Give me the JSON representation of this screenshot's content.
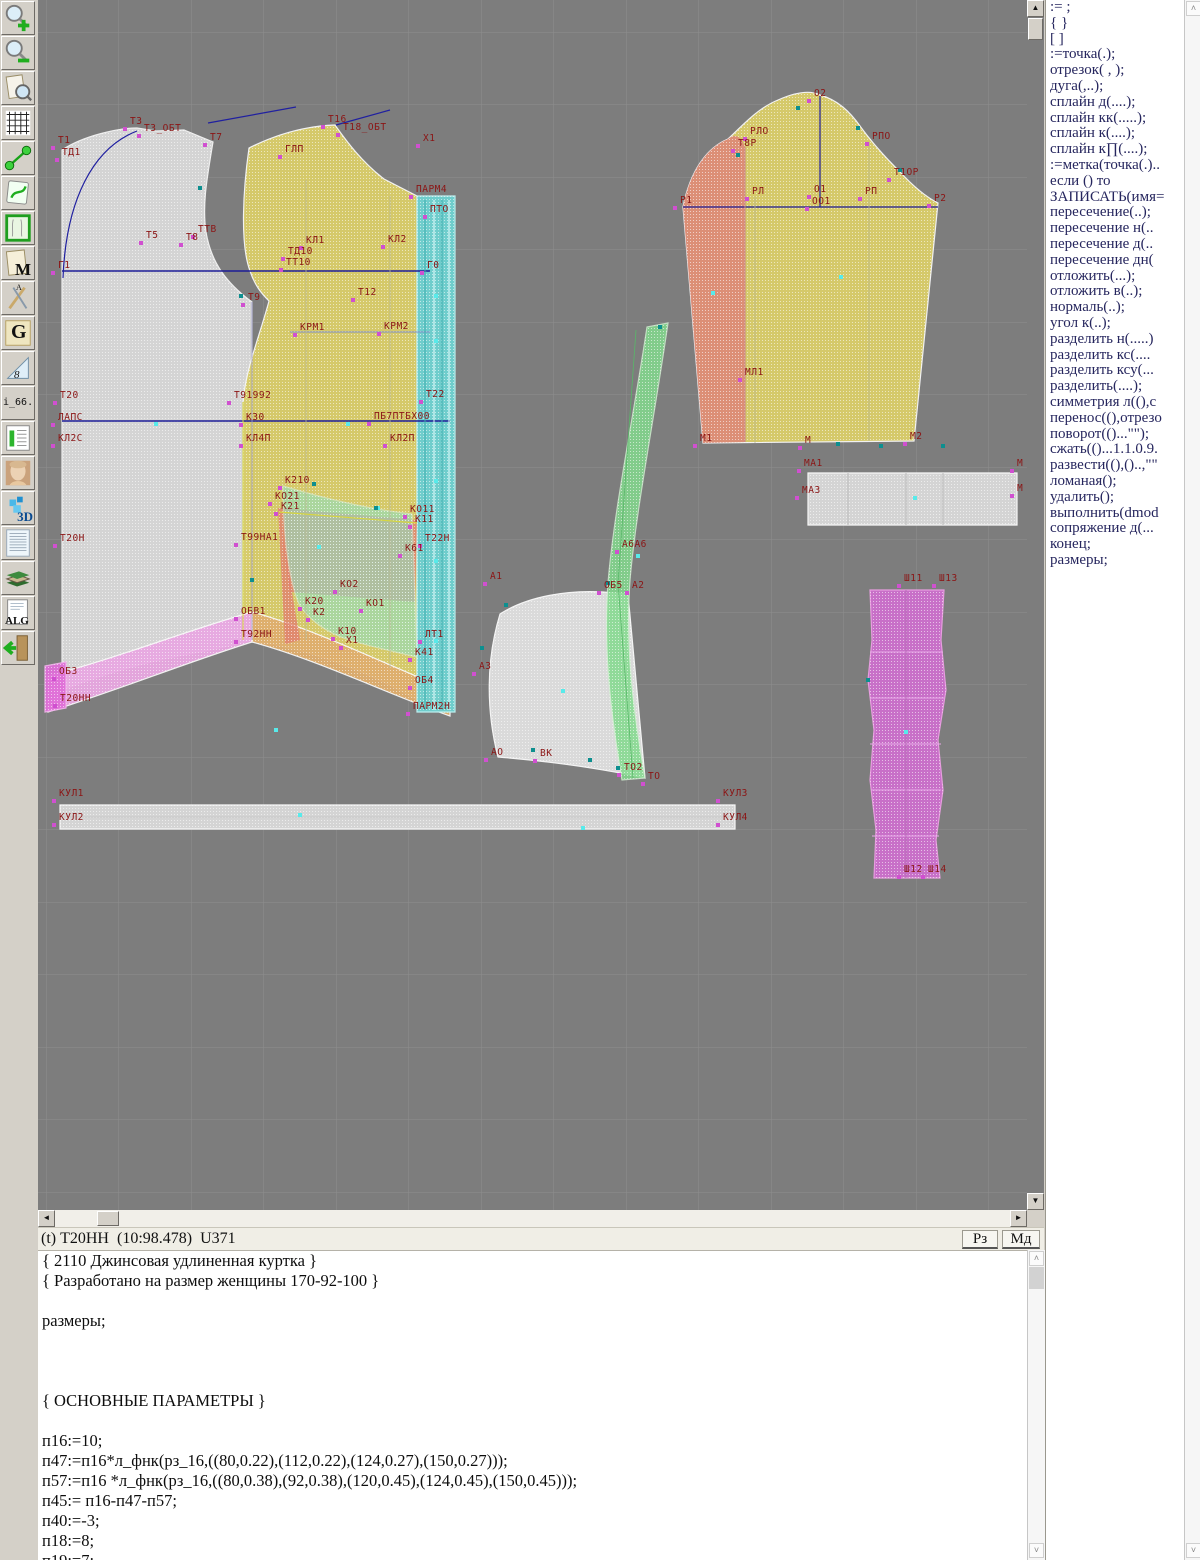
{
  "toolbar": {
    "items": [
      {
        "name": "zoom-in-tool"
      },
      {
        "name": "zoom-out-tool"
      },
      {
        "name": "preview-tool"
      },
      {
        "name": "grid-tool"
      },
      {
        "name": "measure-tool"
      },
      {
        "name": "sketch-tool"
      },
      {
        "name": "pattern-frame-tool"
      },
      {
        "name": "m-document-tool",
        "glyph": "M"
      },
      {
        "name": "drafting-tool",
        "glyph": "A"
      },
      {
        "name": "g-curves-tool",
        "glyph": "G"
      },
      {
        "name": "ruler-tool",
        "glyph": "8"
      },
      {
        "name": "i66-tool",
        "glyph": "i_66."
      },
      {
        "name": "size-table-tool"
      },
      {
        "name": "portrait-tool"
      },
      {
        "name": "three-d-tool",
        "glyph": "3D"
      },
      {
        "name": "text-page-tool"
      },
      {
        "name": "books-tool"
      },
      {
        "name": "alg-tool",
        "glyph": "ALG"
      },
      {
        "name": "exit-tool"
      }
    ]
  },
  "drawing": {
    "bg": "#7d7d7d",
    "grid_color": "#8e8e8e",
    "label_color": "#8b1515",
    "accent_navy": "#1c1c96",
    "marker_magenta": "#d050d0",
    "marker_cyan": "#58eaea",
    "marker_teal": "#0d8f8f",
    "pieces": [
      {
        "n": "back-piece",
        "p": "M 24,690 C 60,676 100,664 140,656 C 168,651 192,646 214,640 L 214,302 C 188,283 173,262 168,232 C 164,205 169,178 175,142 L 146,130 L 118,131 L 99,128 C 80,128 45,136 24,150 Z",
        "f": "#d9d9d9",
        "s": "#f5f5f5",
        "o": 0.95
      },
      {
        "n": "front-piece",
        "p": "M 211,148 C 237,135 267,126 297,125 C 309,142 324,162 346,179 L 379,196 L 379,700 C 332,672 266,646 205,640 L 205,402 C 208,368 221,338 231,301 C 224,294 217,286 212,271 C 202,244 205,190 211,148 Z",
        "f": "#d8cc6a",
        "s": "#f5f5f5",
        "o": 0.97
      },
      {
        "n": "hem-band-pink",
        "p": "M 10,676 C 80,658 150,630 214,612 L 214,642 C 150,662 80,690 10,712 Z",
        "f": "#e9a8e2",
        "s": "#f8f8f8",
        "o": 0.95
      },
      {
        "n": "hem-block-pink",
        "p": "M 7,666 L 28,662 L 28,708 L 7,712 Z",
        "f": "#e070d8",
        "s": "#f0b0ea",
        "o": 0.95
      },
      {
        "n": "hem-band-salmon",
        "p": "M 214,612 C 280,630 350,666 412,690 L 412,716 C 350,694 280,660 214,642 Z",
        "f": "#dfae6e",
        "s": "#f8f8f8",
        "o": 0.95
      },
      {
        "n": "facing-strip-cyan",
        "p": "M 379,196 L 417,196 L 417,712 L 379,712 Z",
        "f": "#6fd0cf",
        "s": "#bff2f2",
        "o": 0.97
      },
      {
        "n": "pocket-red",
        "p": "M 240,508 L 379,520 L 377,602 L 252,592 Z",
        "f": "#e08070",
        "s": "none",
        "o": 0.78
      },
      {
        "n": "pocket-red-sliver",
        "p": "M 240,508 L 262,640 L 247,644 Z",
        "f": "#e08070",
        "s": "none",
        "o": 0.78
      },
      {
        "n": "pocket-teal",
        "p": "M 245,486 C 292,500 336,510 374,514 L 379,657 C 348,650 318,643 303,637 C 283,629 268,616 261,604 C 250,578 245,528 245,486 Z",
        "f": "#90dfc2",
        "s": "#cfeedd",
        "o": 0.6
      },
      {
        "n": "sleeve-piece",
        "p": "M 645,207 C 652,172 668,148 690,139 C 705,125 720,108 740,100 C 758,92 772,90 782,95 C 800,100 812,112 822,126 C 832,140 845,155 862,172 C 875,186 888,197 900,203 L 876,441 L 665,443 Z",
        "f": "#d8cc6a",
        "s": "#f5f5f5",
        "o": 0.97
      },
      {
        "n": "sleeve-undersection",
        "p": "M 645,207 C 652,172 668,148 690,139 C 698,132 704,138 707,147 L 707,442 L 665,443 Z",
        "f": "#dd8878",
        "s": "none",
        "o": 0.9
      },
      {
        "n": "cuff-strip",
        "p": "M 770,473 L 979,473 L 979,525 L 770,525 Z",
        "f": "#d9d9d9",
        "s": "#ffffff",
        "o": 0.95
      },
      {
        "n": "collar-piece",
        "p": "M 462,614 C 490,596 530,590 565,592 L 590,594 L 598,680 L 607,778 C 570,770 520,762 460,757 C 448,710 448,660 462,614 Z",
        "f": "#e0e0e0",
        "s": "#fbfbfb",
        "o": 0.95
      },
      {
        "n": "binding-strip-green",
        "p": "M 609,327 L 630,323 C 616,420 598,510 592,580 C 587,650 596,715 607,778 L 584,780 C 573,715 565,650 570,583 C 576,510 595,420 609,327 Z",
        "f": "#84da8e",
        "s": "#cfeecf",
        "o": 0.85
      },
      {
        "n": "placket-magenta",
        "p": "M 832,590 L 906,590 L 903,640 L 908,690 L 900,740 L 905,790 L 898,840 L 902,878 L 836,878 L 838,830 L 832,780 L 836,730 L 830,680 L 834,640 Z",
        "f": "#cf6fcf",
        "s": "#f0a0e8",
        "o": 0.92
      },
      {
        "n": "belt-strip",
        "p": "M 22,805 L 697,805 L 697,829 L 22,829 Z",
        "f": "#d9d9d9",
        "s": "#ffffff",
        "o": 0.95
      }
    ],
    "lines": [
      {
        "p": "M 24,271 L 392,271",
        "c": "#1c1c96",
        "w": 1.5
      },
      {
        "p": "M 24,421 L 412,421",
        "c": "#1c1c96",
        "w": 1.5
      },
      {
        "p": "M 25,278 C 28,200 55,148 99,131",
        "c": "#2020a0",
        "w": 1.2
      },
      {
        "p": "M 170,123 L 258,107",
        "c": "#2020a0",
        "w": 1.2
      },
      {
        "p": "M 298,125 L 352,110",
        "c": "#2020a0",
        "w": 1.2
      },
      {
        "p": "M 645,207 L 900,207",
        "c": "#1c1c96",
        "w": 1.2
      },
      {
        "p": "M 782,96 L 782,207",
        "c": "#1c1c96",
        "w": 1.2
      },
      {
        "p": "M 252,332 L 392,332",
        "c": "#8090c8",
        "w": 1
      },
      {
        "p": "M 268,180 L 268,640",
        "c": "#b8b890",
        "w": 0.8
      },
      {
        "p": "M 352,196 L 352,668",
        "c": "#b8b890",
        "w": 0.8
      },
      {
        "p": "M 241,512 L 379,523",
        "c": "#d6d640",
        "w": 1.2
      },
      {
        "p": "M 205,402 L 205,640",
        "c": "#d6d640",
        "w": 1
      },
      {
        "p": "M 214,302 L 214,640",
        "c": "#9898c8",
        "w": 0.8
      },
      {
        "p": "M 387,200 L 387,710",
        "c": "#3fafaf",
        "w": 1
      },
      {
        "p": "M 396,200 L 396,710",
        "c": "#e8ffff",
        "w": 1
      },
      {
        "p": "M 404,200 L 404,710",
        "c": "#3fafaf",
        "w": 1
      },
      {
        "p": "M 411,200 L 411,710",
        "c": "#e8ffff",
        "w": 1
      },
      {
        "p": "M 707,147 L 707,442",
        "c": "#cc8888",
        "w": 1
      },
      {
        "p": "M 717,197 L 717,443",
        "c": "#b8b890",
        "w": 0.8
      },
      {
        "p": "M 831,142 L 831,441",
        "c": "#b8b890",
        "w": 0.8
      },
      {
        "p": "M 810,473 L 810,525",
        "c": "#bbbbbb",
        "w": 1
      },
      {
        "p": "M 868,473 L 868,525",
        "c": "#bbbbbb",
        "w": 1
      },
      {
        "p": "M 905,473 L 905,525",
        "c": "#bbbbbb",
        "w": 1
      },
      {
        "p": "M 22,817 L 697,817",
        "c": "#c8c8c8",
        "w": 1
      },
      {
        "p": "M 832,652 L 905,652",
        "c": "#e9a8e9",
        "w": 1
      },
      {
        "p": "M 832,698 L 906,698",
        "c": "#e9a8e9",
        "w": 1
      },
      {
        "p": "M 832,744 L 903,744",
        "c": "#e9a8e9",
        "w": 1
      },
      {
        "p": "M 833,790 L 903,790",
        "c": "#e9a8e9",
        "w": 1
      },
      {
        "p": "M 834,836 L 901,836",
        "c": "#e9a8e9",
        "w": 1
      },
      {
        "p": "M 868,590 L 868,878",
        "c": "#b86ab8",
        "w": 1
      },
      {
        "p": "M 598,330 L 580,583 L 595,778",
        "c": "#58b868",
        "w": 0.8
      }
    ],
    "labels": [
      [
        "Т1",
        20,
        143
      ],
      [
        "ТД1",
        24,
        155
      ],
      [
        "Т3",
        92,
        124
      ],
      [
        "Т3_ОБТ",
        106,
        131
      ],
      [
        "Т7",
        172,
        140
      ],
      [
        "Т5",
        108,
        238
      ],
      [
        "Т8",
        148,
        240
      ],
      [
        "ТТВ",
        160,
        232
      ],
      [
        "Г1",
        20,
        268
      ],
      [
        "Т9",
        210,
        300
      ],
      [
        "Т20",
        22,
        398
      ],
      [
        "ЛАПС",
        20,
        420
      ],
      [
        "КЛ2С",
        20,
        441
      ],
      [
        "Т20Н",
        22,
        541
      ],
      [
        "ОБ3",
        21,
        674
      ],
      [
        "Т20НН",
        22,
        701
      ],
      [
        "ГЛП",
        247,
        152
      ],
      [
        "Т16",
        290,
        122
      ],
      [
        "Т18_ОБТ",
        305,
        130
      ],
      [
        "Х1",
        385,
        141
      ],
      [
        "ПАРМ4",
        378,
        192
      ],
      [
        "ПТО",
        392,
        212
      ],
      [
        "КЛ1",
        268,
        243
      ],
      [
        "КЛ2",
        350,
        242
      ],
      [
        "ТД10",
        250,
        254
      ],
      [
        "ТТ10",
        248,
        265
      ],
      [
        "Г0",
        389,
        268
      ],
      [
        "Т12",
        320,
        295
      ],
      [
        "КРМ1",
        262,
        330
      ],
      [
        "КРМ2",
        346,
        329
      ],
      [
        "Т91992",
        196,
        398
      ],
      [
        "Т22",
        388,
        397
      ],
      [
        "К30",
        208,
        420
      ],
      [
        "ПБ7ПТБХ00",
        336,
        419
      ],
      [
        "КЛ4П",
        208,
        441
      ],
      [
        "КЛ2П",
        352,
        441
      ],
      [
        "К210",
        247,
        483
      ],
      [
        "КО21",
        237,
        499
      ],
      [
        "К21",
        243,
        509
      ],
      [
        "КО11",
        372,
        512
      ],
      [
        "К11",
        377,
        522
      ],
      [
        "Т99НА1",
        203,
        540
      ],
      [
        "Т22Н",
        387,
        541
      ],
      [
        "К61",
        367,
        551
      ],
      [
        "КО2",
        302,
        587
      ],
      [
        "К20",
        267,
        604
      ],
      [
        "КО1",
        328,
        606
      ],
      [
        "К2",
        275,
        615
      ],
      [
        "ОБВ1",
        203,
        614
      ],
      [
        "Т92НН",
        203,
        637
      ],
      [
        "К10",
        300,
        634
      ],
      [
        "Х1",
        308,
        643
      ],
      [
        "ЛТ1",
        387,
        637
      ],
      [
        "К41",
        377,
        655
      ],
      [
        "ОБ4",
        377,
        683
      ],
      [
        "ПАРМ2Н",
        375,
        709
      ],
      [
        "А1",
        452,
        579
      ],
      [
        "А3",
        441,
        669
      ],
      [
        "АО",
        453,
        755
      ],
      [
        "ВК",
        502,
        756
      ],
      [
        "ТО2",
        586,
        770
      ],
      [
        "ТО",
        610,
        779
      ],
      [
        "ОБ5",
        566,
        588
      ],
      [
        "А2",
        594,
        588
      ],
      [
        "А6А6",
        584,
        547
      ],
      [
        "О2",
        776,
        96
      ],
      [
        "РЛО",
        712,
        134
      ],
      [
        "Т8Р",
        700,
        146
      ],
      [
        "РПО",
        834,
        139
      ],
      [
        "Т1ОР",
        856,
        175
      ],
      [
        "РЛ",
        714,
        194
      ],
      [
        "О1",
        776,
        192
      ],
      [
        "ОО1",
        774,
        204
      ],
      [
        "РП",
        827,
        194
      ],
      [
        "Р1",
        642,
        203
      ],
      [
        "Р2",
        896,
        201
      ],
      [
        "МЛ1",
        707,
        375
      ],
      [
        "М1",
        662,
        441
      ],
      [
        "М",
        767,
        443
      ],
      [
        "М2",
        872,
        439
      ],
      [
        "МА1",
        766,
        466
      ],
      [
        "МА3",
        764,
        493
      ],
      [
        "М",
        979,
        466
      ],
      [
        "М",
        979,
        491
      ],
      [
        "Ш11",
        866,
        581
      ],
      [
        "Ш13",
        901,
        581
      ],
      [
        "Ш12",
        866,
        872
      ],
      [
        "Ш14",
        890,
        872
      ],
      [
        "КУЛ1",
        21,
        796
      ],
      [
        "КУЛ2",
        21,
        820
      ],
      [
        "КУЛ3",
        685,
        796
      ],
      [
        "КУЛ4",
        685,
        820
      ]
    ],
    "cyan_markers": [
      [
        118,
        424
      ],
      [
        310,
        424
      ],
      [
        398,
        296
      ],
      [
        398,
        341
      ],
      [
        398,
        481
      ],
      [
        398,
        561
      ],
      [
        398,
        641
      ],
      [
        803,
        277
      ],
      [
        675,
        293
      ],
      [
        262,
        815
      ],
      [
        525,
        691
      ],
      [
        868,
        732
      ],
      [
        877,
        498
      ],
      [
        600,
        556
      ],
      [
        340,
        508
      ],
      [
        281,
        547
      ],
      [
        238,
        730
      ],
      [
        545,
        828
      ]
    ],
    "teal_markers": [
      [
        162,
        188
      ],
      [
        203,
        296
      ],
      [
        276,
        484
      ],
      [
        338,
        508
      ],
      [
        622,
        327
      ],
      [
        570,
        583
      ],
      [
        495,
        750
      ],
      [
        552,
        760
      ],
      [
        580,
        768
      ],
      [
        700,
        155
      ],
      [
        760,
        108
      ],
      [
        820,
        128
      ],
      [
        862,
        170
      ],
      [
        843,
        446
      ],
      [
        905,
        446
      ],
      [
        830,
        680
      ],
      [
        468,
        605
      ],
      [
        444,
        648
      ],
      [
        800,
        444
      ],
      [
        214,
        580
      ]
    ]
  },
  "command_panel": {
    "items": [
      ":= ;",
      "{  }",
      "[  ]",
      ":=точка(.);",
      "отрезок( , );",
      "дуга(,..);",
      "сплайн  д(....);",
      "сплайн  кк(.....);",
      "сплайн  к(....);",
      "сплайн  к∏(....);",
      ":=метка(точка(.)..",
      "если () то",
      "ЗАПИСАТЬ(имя=",
      "пересечение(..);",
      "пересечение  н(..",
      "пересечение  д(..",
      "пересечение  дн(",
      "отложить(...);",
      "отложить  в(..);",
      "нормаль(..);",
      "угол  к(..);",
      "разделить  н(.....)",
      "разделить  кс(....",
      "разделить  ксу(...",
      "разделить(....);",
      "симметрия  л((),с",
      "перенос((),отрезо",
      "поворот(()...\"\");",
      "сжать(()...1.1.0.9.",
      "развести((),()..,\"\"",
      "ломаная();",
      "удалить();",
      "выполнить(dmod",
      "сопряжение  д(...",
      "конец;",
      "размеры;"
    ]
  },
  "status_bar": {
    "text": "(t) Т20НН  (10:98.478)  U371",
    "buttons": [
      {
        "label": "Рз"
      },
      {
        "label": "Мд"
      }
    ]
  },
  "editor": {
    "lines": [
      "{ 2110 Джинсовая удлиненная куртка }",
      "{ Разработано на размер женщины 170-92-100 }",
      "",
      "размеры;",
      "",
      "",
      "",
      "{ ОСНОВНЫЕ ПАРАМЕТРЫ }",
      "",
      "п16:=10;",
      "п47:=п16*л_фнк(рз_16,((80,0.22),(112,0.22),(124,0.27),(150,0.27)));",
      "п57:=п16 *л_фнк(рз_16,((80,0.38),(92,0.38),(120,0.45),(124,0.45),(150,0.45)));",
      "п45:= п16-п47-п57;",
      "п40:=-3;",
      "п18:=8;",
      "п19:=7;"
    ]
  },
  "scroll_glyphs": {
    "up": "▲",
    "down": "▼",
    "left": "◄",
    "right": "►",
    "chev_up": "˄",
    "chev_down": "˅"
  }
}
